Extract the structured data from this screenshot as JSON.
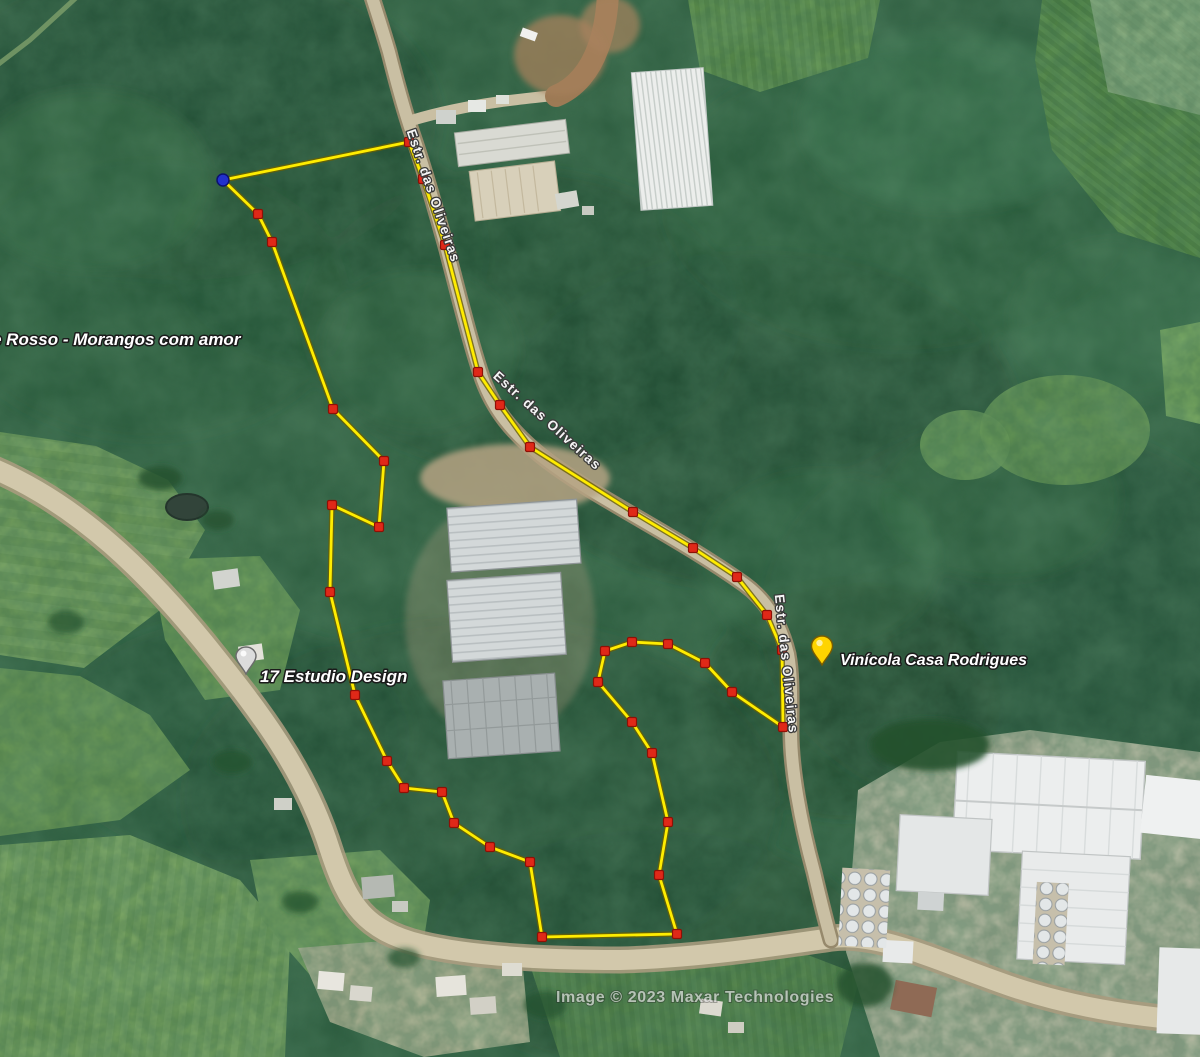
{
  "labels": {
    "farm": "e Rosso -  Morangos com amor",
    "studio": "17 Estudio Design",
    "winery": "Vinícola Casa Rodrigues",
    "road": "Estr. das Oliveiras",
    "attribution": "Image © 2023 Maxar Technologies"
  },
  "pins": {
    "winery_color": "#ffd400",
    "studio_color": "#dcdcdc"
  },
  "polygon": {
    "line_color": "#ffec00",
    "casing_color": "#6b6000",
    "vertex_color": "#e02818",
    "start_color": "#2230cc",
    "points": [
      [
        223,
        180
      ],
      [
        409,
        142
      ],
      [
        423,
        179
      ],
      [
        445,
        245
      ],
      [
        478,
        372
      ],
      [
        500,
        405
      ],
      [
        530,
        447
      ],
      [
        633,
        512
      ],
      [
        693,
        548
      ],
      [
        737,
        577
      ],
      [
        767,
        615
      ],
      [
        782,
        650
      ],
      [
        783,
        727
      ],
      [
        732,
        692
      ],
      [
        705,
        663
      ],
      [
        668,
        644
      ],
      [
        632,
        642
      ],
      [
        605,
        651
      ],
      [
        598,
        682
      ],
      [
        632,
        722
      ],
      [
        652,
        753
      ],
      [
        668,
        822
      ],
      [
        659,
        875
      ],
      [
        677,
        934
      ],
      [
        542,
        937
      ],
      [
        530,
        862
      ],
      [
        490,
        847
      ],
      [
        454,
        823
      ],
      [
        442,
        792
      ],
      [
        404,
        788
      ],
      [
        387,
        761
      ],
      [
        355,
        695
      ],
      [
        330,
        592
      ],
      [
        332,
        505
      ],
      [
        379,
        527
      ],
      [
        384,
        461
      ],
      [
        333,
        409
      ],
      [
        272,
        242
      ],
      [
        258,
        214
      ]
    ]
  }
}
